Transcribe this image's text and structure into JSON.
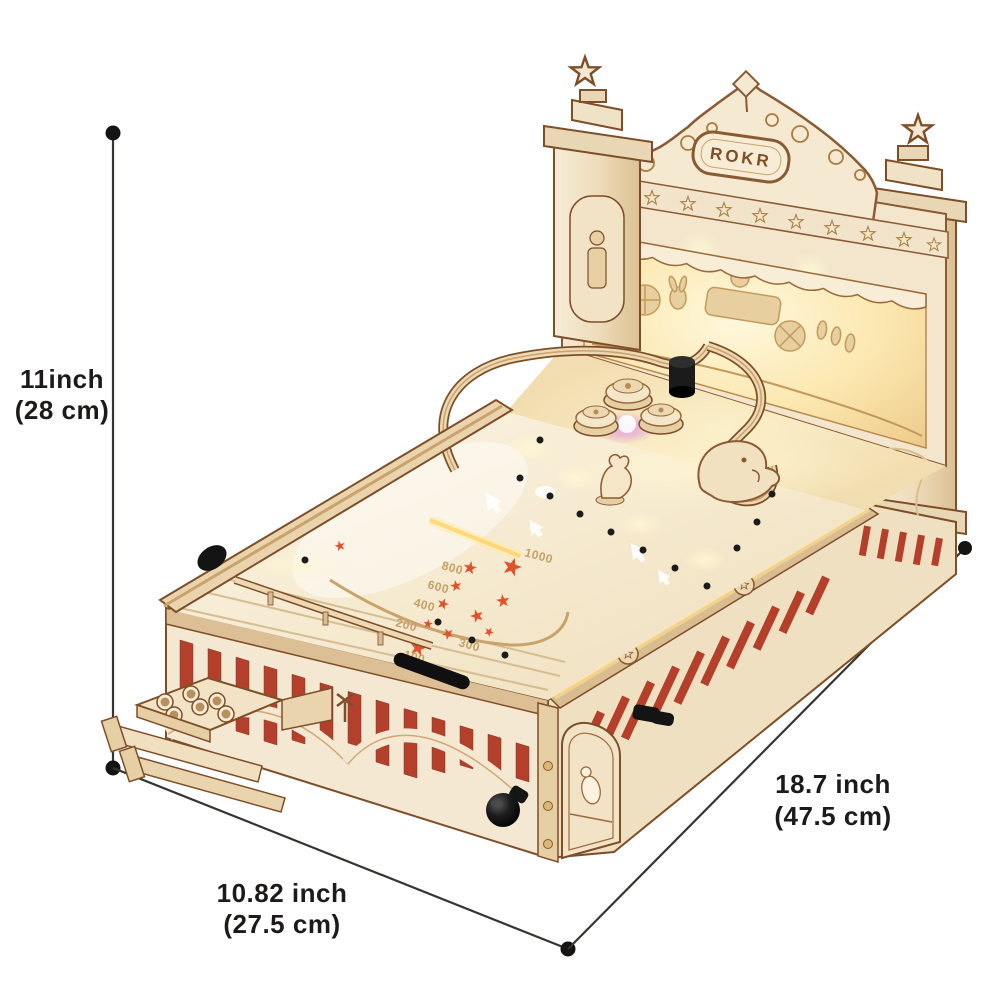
{
  "product": {
    "brand": "ROKR",
    "name": "ROKR 3D Wooden Puzzle Pinball Machine",
    "playfield": {
      "scores": [
        "1000",
        "800",
        "600",
        "400",
        "300",
        "200",
        "100"
      ]
    }
  },
  "dimensions": {
    "height_in": "11inch",
    "height_cm": "(28 cm)",
    "width_in": "10.82 inch",
    "width_cm": "(27.5 cm)",
    "depth_in": "18.7 inch",
    "depth_cm": "(47.5 cm)"
  },
  "colors": {
    "background": "#ffffff",
    "wood_light": "#f4e8d2",
    "wood_mid": "#e6cfa4",
    "wood_dark": "#7e4e28",
    "stripe_red": "#b4402c",
    "star_orange": "#e2512b",
    "led_warm": "#ffe9a8",
    "led_purple": "#e09be8",
    "annotation_line": "#38342f",
    "label_text": "#1d1b19"
  }
}
